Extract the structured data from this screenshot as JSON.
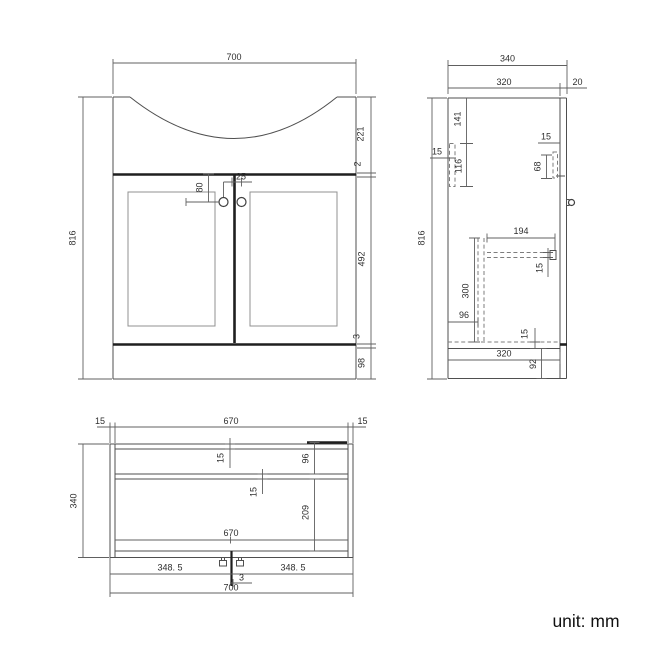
{
  "drawing": {
    "type": "technical-drawing",
    "subject": "bathroom vanity basin unit",
    "unit_label": "unit: mm",
    "colors": {
      "background": "#ffffff",
      "outline": "#4f4f4f",
      "panel_line": "#909090",
      "thick_line": "#1f1f1f",
      "hidden_line": "#7d7d7d",
      "dimension": "#606060",
      "dim_text": "#2e2e2e"
    }
  },
  "views": {
    "front": {
      "label": "front elevation",
      "dims": {
        "overall_width": "700",
        "overall_height": "816",
        "basin_height": "221",
        "worktop_edge": "2",
        "door_height": "492",
        "bottom_gap": "3",
        "plinth_height": "98",
        "handle_drop": "80",
        "handle_spacing": "25"
      }
    },
    "side": {
      "label": "side elevation",
      "dims": {
        "overall_depth": "340",
        "carcass_depth": "320",
        "door_thickness": "20",
        "overall_height": "816",
        "hinge_plate_offset": "141",
        "hinge_plate_width": "15",
        "hinge_plate_height": "116",
        "door_plate_width": "15",
        "door_plate_height": "68",
        "shelf_depth": "194",
        "shelf_thickness": "15",
        "support_height": "300",
        "support_offset": "96",
        "bottom_panel_thickness": "15",
        "bottom_depth": "320",
        "plinth_height": "92"
      }
    },
    "plan": {
      "label": "plan view",
      "dims": {
        "left_panel_thickness": "15",
        "inner_width_back": "670",
        "right_panel_thickness": "15",
        "overall_depth": "340",
        "back_panel_thickness": "15",
        "back_shelf_offset": "96",
        "shelf_thickness": "15",
        "front_depth": "209",
        "inner_width_front": "670",
        "door_left_width": "348. 5",
        "door_right_width": "348. 5",
        "center_gap": "3",
        "overall_width": "700"
      }
    }
  }
}
